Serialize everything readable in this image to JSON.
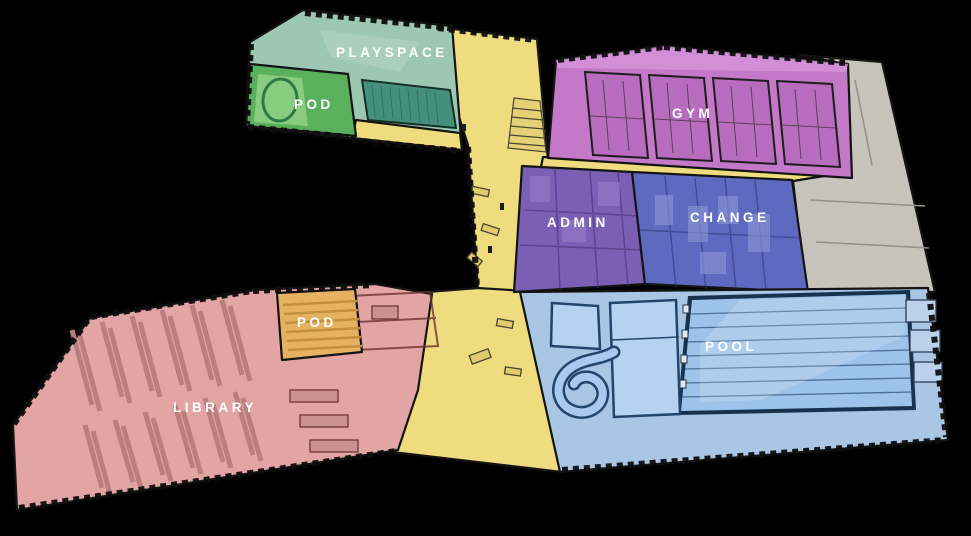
{
  "scene": {
    "type": "axonometric-floor-plan",
    "background": "#000000"
  },
  "zones": {
    "playspace": {
      "label": "PLAYSPACE",
      "color": "#9cc7b2"
    },
    "pod_upper": {
      "label": "POD",
      "color": "#5ab05c"
    },
    "gym": {
      "label": "GYM",
      "color": "#c478c8"
    },
    "admin": {
      "label": "ADMIN",
      "color": "#7a5fb4"
    },
    "change": {
      "label": "CHANGE",
      "color": "#5d6abf"
    },
    "pool": {
      "label": "POOL",
      "color": "#aac6e5"
    },
    "pod_lower": {
      "label": "POD",
      "color": "#e4b260"
    },
    "library": {
      "label": "LIBRARY",
      "color": "#e2a5a3"
    },
    "circulation": {
      "color": "#eedc7e"
    },
    "service": {
      "color": "#c7c4bb"
    }
  },
  "colors": {
    "water": "#9dc3ea",
    "water_light": "#b5d3f0",
    "label_text": "#ffffff",
    "linework": "#141414"
  }
}
